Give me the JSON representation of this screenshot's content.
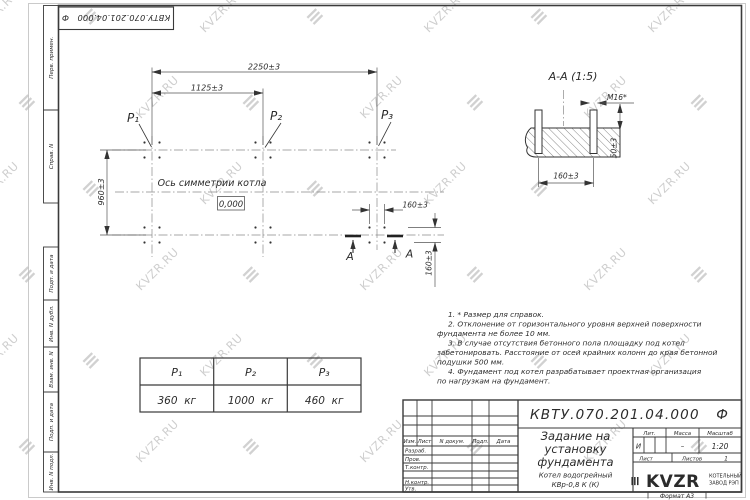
{
  "watermark": {
    "text": "KVZR.RU",
    "glyph": "≡"
  },
  "sidebar": {
    "labels": [
      "Перв. примен.",
      "Справ. N",
      "Подп. и дата",
      "Инв. N дубл.",
      "Взам. инв. N",
      "Подп. и дата",
      "Инв. N подл."
    ]
  },
  "plan": {
    "dim_total": "2250±3",
    "dim_half": "1125±3",
    "dim_depth": "960±3",
    "dim_bolt_h": "160±3",
    "dim_bolt_v": "160±3",
    "p1": "Р₁",
    "p2": "Р₂",
    "p3": "Р₃",
    "axis_label": "Ось симметрии котла",
    "level": "0,000",
    "section_letter_left": "А",
    "section_letter_right": "А"
  },
  "section": {
    "title": "А-А (1:5)",
    "bolt": "М16*",
    "dim_protrusion": "50±3",
    "dim_spacing": "160±3"
  },
  "notes": {
    "lines": [
      "1. * Размер для справок.",
      "2. Отклонение от горизонтального уровня верхней поверхности",
      "фундамента не более 10 мм.",
      "3. В случае отсутствия бетонного пола площадку под котел",
      "забетонировать. Расстояние от осей крайних колонн до края бетонной",
      "подушки 500 мм.",
      "4. Фундамент под котел разрабатывает проектная организация",
      "по нагрузкам на фундамент."
    ]
  },
  "load_table": {
    "headers": [
      "Р₁",
      "Р₂",
      "Р₃"
    ],
    "values": [
      "360  кг",
      "1000  кг",
      "460  кг"
    ]
  },
  "title_block": {
    "doc_number": "КВТУ.070.201.04.000   Ф",
    "title_line1": "Задание на",
    "title_line2": "установку",
    "title_line3": "фундамента",
    "product_line1": "Котел водогрейный",
    "product_line2": "КВр-0,8 К (К)",
    "col_izm": "Изм.",
    "col_list": "Лист",
    "col_doc": "N докум.",
    "col_sign": "Подп.",
    "col_date": "Дата",
    "row_developed": "Разраб.",
    "row_checked": "Пров.",
    "row_tcontrol": "Т.контр.",
    "row_ncontrol": "Н.контр.",
    "row_approved": "Утв.",
    "lit_label": "Лит.",
    "lit_value": "И",
    "mass_label": "Масса",
    "mass_value": "–",
    "scale_label": "Масштаб",
    "scale_value": "1:20",
    "sheet_label": "Лист",
    "sheets_label": "Листов",
    "sheets_value": "1",
    "logo_text": "KVZR",
    "company_line1": "КОТЕЛЬНЫЙ",
    "company_line2": "ЗАВОД РЭП",
    "format_label": "Формат А3"
  }
}
